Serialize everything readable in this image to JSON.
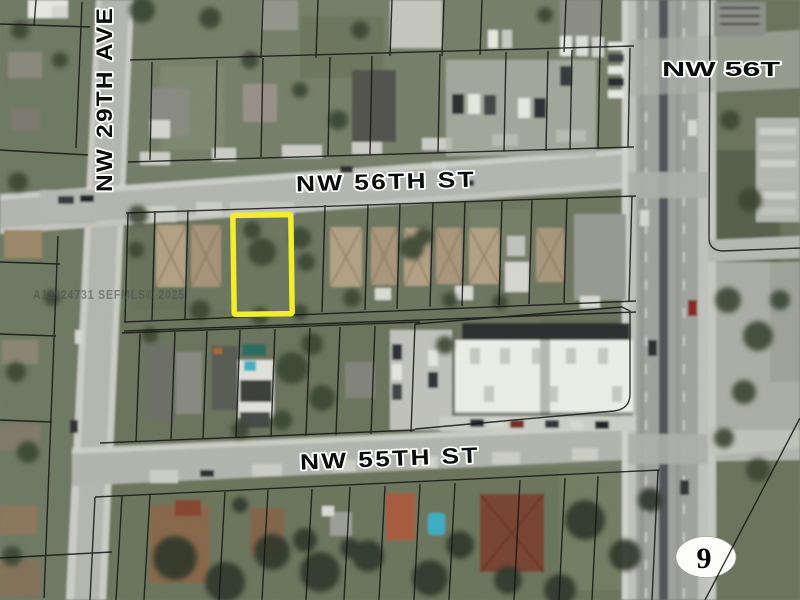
{
  "map": {
    "streets": {
      "nw_56th_st": "NW 56TH ST",
      "nw_55th_st": "NW 55TH ST",
      "nw_29th_ave": "NW 29TH AVE",
      "nw_56th_st_east": "NW 56T"
    },
    "watermark": "A11924731 SEFMLS© 2025",
    "route_shield_number": "9",
    "colors": {
      "parcel_highlight": "#f2ee2b",
      "parcel_line": "#141414",
      "street_label_fill": "#0c0c0c",
      "street_label_halo": "#ffffff",
      "watermark_fill": "#4f4f4f",
      "shield_fill": "#fdfdfa",
      "shield_number_fill": "#000000"
    }
  }
}
